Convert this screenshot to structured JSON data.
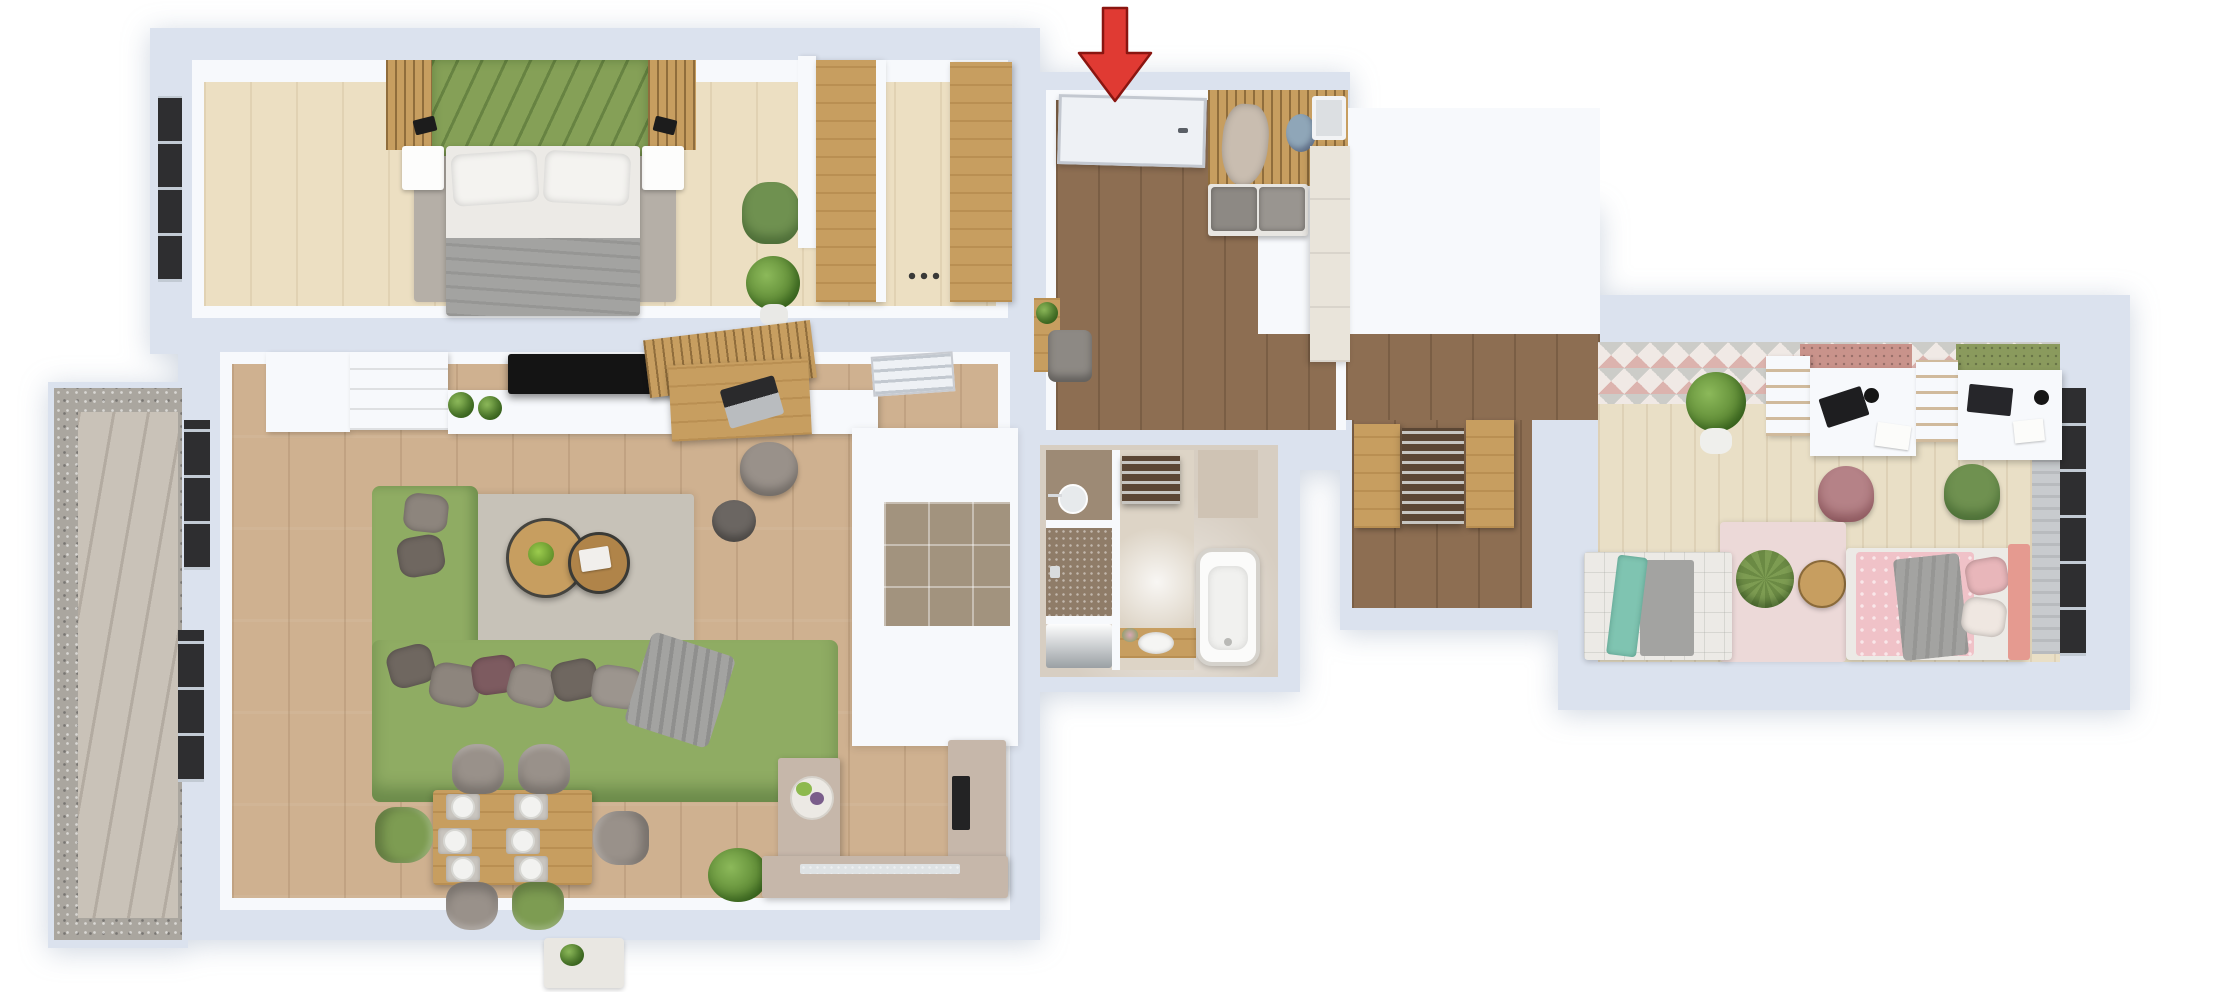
{
  "scene": {
    "type": "3d-floor-plan-top-view",
    "description": "3D top-down architectural rendering of a two-bedroom apartment with balcony; a red arrow at the top marks the main entrance. No text labels are rendered.",
    "entrance_marker": {
      "icon": "red-arrow-down-icon",
      "meaning": "main entrance",
      "direction": "down"
    }
  },
  "colors": {
    "wall": "#dbe2ee",
    "wall-face": "#f7f9fc",
    "bedroom-floor": "#ecdfc2",
    "living-floor": "#cfb190",
    "hall-floor": "#8d6e52",
    "kids-floor": "#e9dfc6",
    "bath-floor": "#d7cec2",
    "bath-central": "#ddd4c6",
    "tile-pantry": "#a2937e",
    "shower-tile": "#8f7c68",
    "vanity-wall": "#9d8a75",
    "counter-taupe": "#c6b7aa",
    "oak": "#c79e60",
    "slat-wood": "#b08449",
    "headboard-green": "#85a057",
    "sofa-green": "#8fac63",
    "chair-green": "#7d9c52",
    "armchair-green": "#6f9150",
    "rug-gray": "#b5afa7",
    "rug-living": "#c7c2b8",
    "fabric-gray": "#99918a",
    "blanket-gray": "#a3a3a1",
    "linen-white": "#eceae6",
    "tv-black": "#141414",
    "arrow-red": "#e03a33",
    "arrow-red-dark": "#8a1510",
    "balcony-plank": "#c9c2b8",
    "gravel": "#aaa69f",
    "wallpaper-base": "#f0e9e5",
    "wallpaper-pink": "#dcb3ae",
    "wallpaper-gray": "#ccccc8",
    "peg-pink": "#c9938b",
    "peg-green": "#8a9a5d",
    "bed-pink": "#f0c2c8",
    "salmon": "#e59a90",
    "teal": "#7fc4b1",
    "rug-pink": "#ecd9d8",
    "cream-cabinet": "#e9e4da",
    "door-dark": "#5b4634",
    "door-white": "#eef1f5",
    "window-dark": "#2e2e30",
    "coat-tan": "#c9bdb0",
    "bag-blue": "#8fa6b8"
  },
  "rooms": [
    {
      "name": "bedroom",
      "floor": "light oak planks",
      "furniture": [
        "double bed with gray blanket",
        "green upholstered headboard",
        "wood slat wall panels",
        "two white nightstands",
        "two black wall sconces",
        "gray area rug",
        "green armchair",
        "potted plant",
        "window"
      ]
    },
    {
      "name": "walk-in-closet",
      "floor": "light oak planks",
      "furniture": [
        "two tall oak wardrobes",
        "shoes"
      ]
    },
    {
      "name": "living-room",
      "floor": "warm oak planks",
      "furniture": [
        "white tv sideboard",
        "black tv",
        "shelf unit with plants",
        "wood desk with laptop",
        "gray desk chair",
        "wood slat desk panel",
        "green corner sofa with pillows",
        "gray throw blanket",
        "two round wood coffee tables",
        "bowl of green apples",
        "magazine",
        "gray pouf",
        "area rug",
        "wood dining table with six place settings",
        "four gray dining chairs",
        "two green dining chairs",
        "white side table with plant",
        "green floor plant",
        "windows"
      ]
    },
    {
      "name": "kitchen",
      "floor": "large beige tiles",
      "furniture": [
        "L-shaped taupe counter",
        "island with fruit tray",
        "sink",
        "dark cooktop",
        "tiled pantry nook"
      ]
    },
    {
      "name": "hallway",
      "floor": "dark walnut planks",
      "furniture": [
        "white entrance door",
        "wood slat coat wall with hooks",
        "hanging coat",
        "blue bag",
        "gray cushioned bench",
        "leaning mirror",
        "tall cream cabinet",
        "wood console with plants",
        "gray pouf",
        "white interior door with glass slats"
      ]
    },
    {
      "name": "bathroom",
      "floor": "glossy beige tiles",
      "furniture": [
        "vanity with round mirror",
        "countertop basin with flowers",
        "walk-in shower",
        "washing machine",
        "white bathtub",
        "dark louvered door",
        "storage niche"
      ]
    },
    {
      "name": "kids-room",
      "floor": "pale striped planks",
      "furniture": [
        "triangle pattern wallpaper wall",
        "double white desk",
        "two bookshelf dividers",
        "pink pegboard",
        "green pegboard",
        "laptop and monitor",
        "pink desk chair",
        "green desk chair",
        "large potted plant",
        "pink rug",
        "green knitted pouf",
        "round side table",
        "single bed with teal throw",
        "single bed with pink bedding and pillows",
        "window with gray curtain"
      ]
    },
    {
      "name": "vestibule",
      "floor": "dark walnut planks",
      "furniture": [
        "two oak wardrobes",
        "dark glazed door"
      ]
    },
    {
      "name": "balcony",
      "floor": "gray diagonal wood decking",
      "furniture": [
        "gravel border"
      ]
    }
  ]
}
